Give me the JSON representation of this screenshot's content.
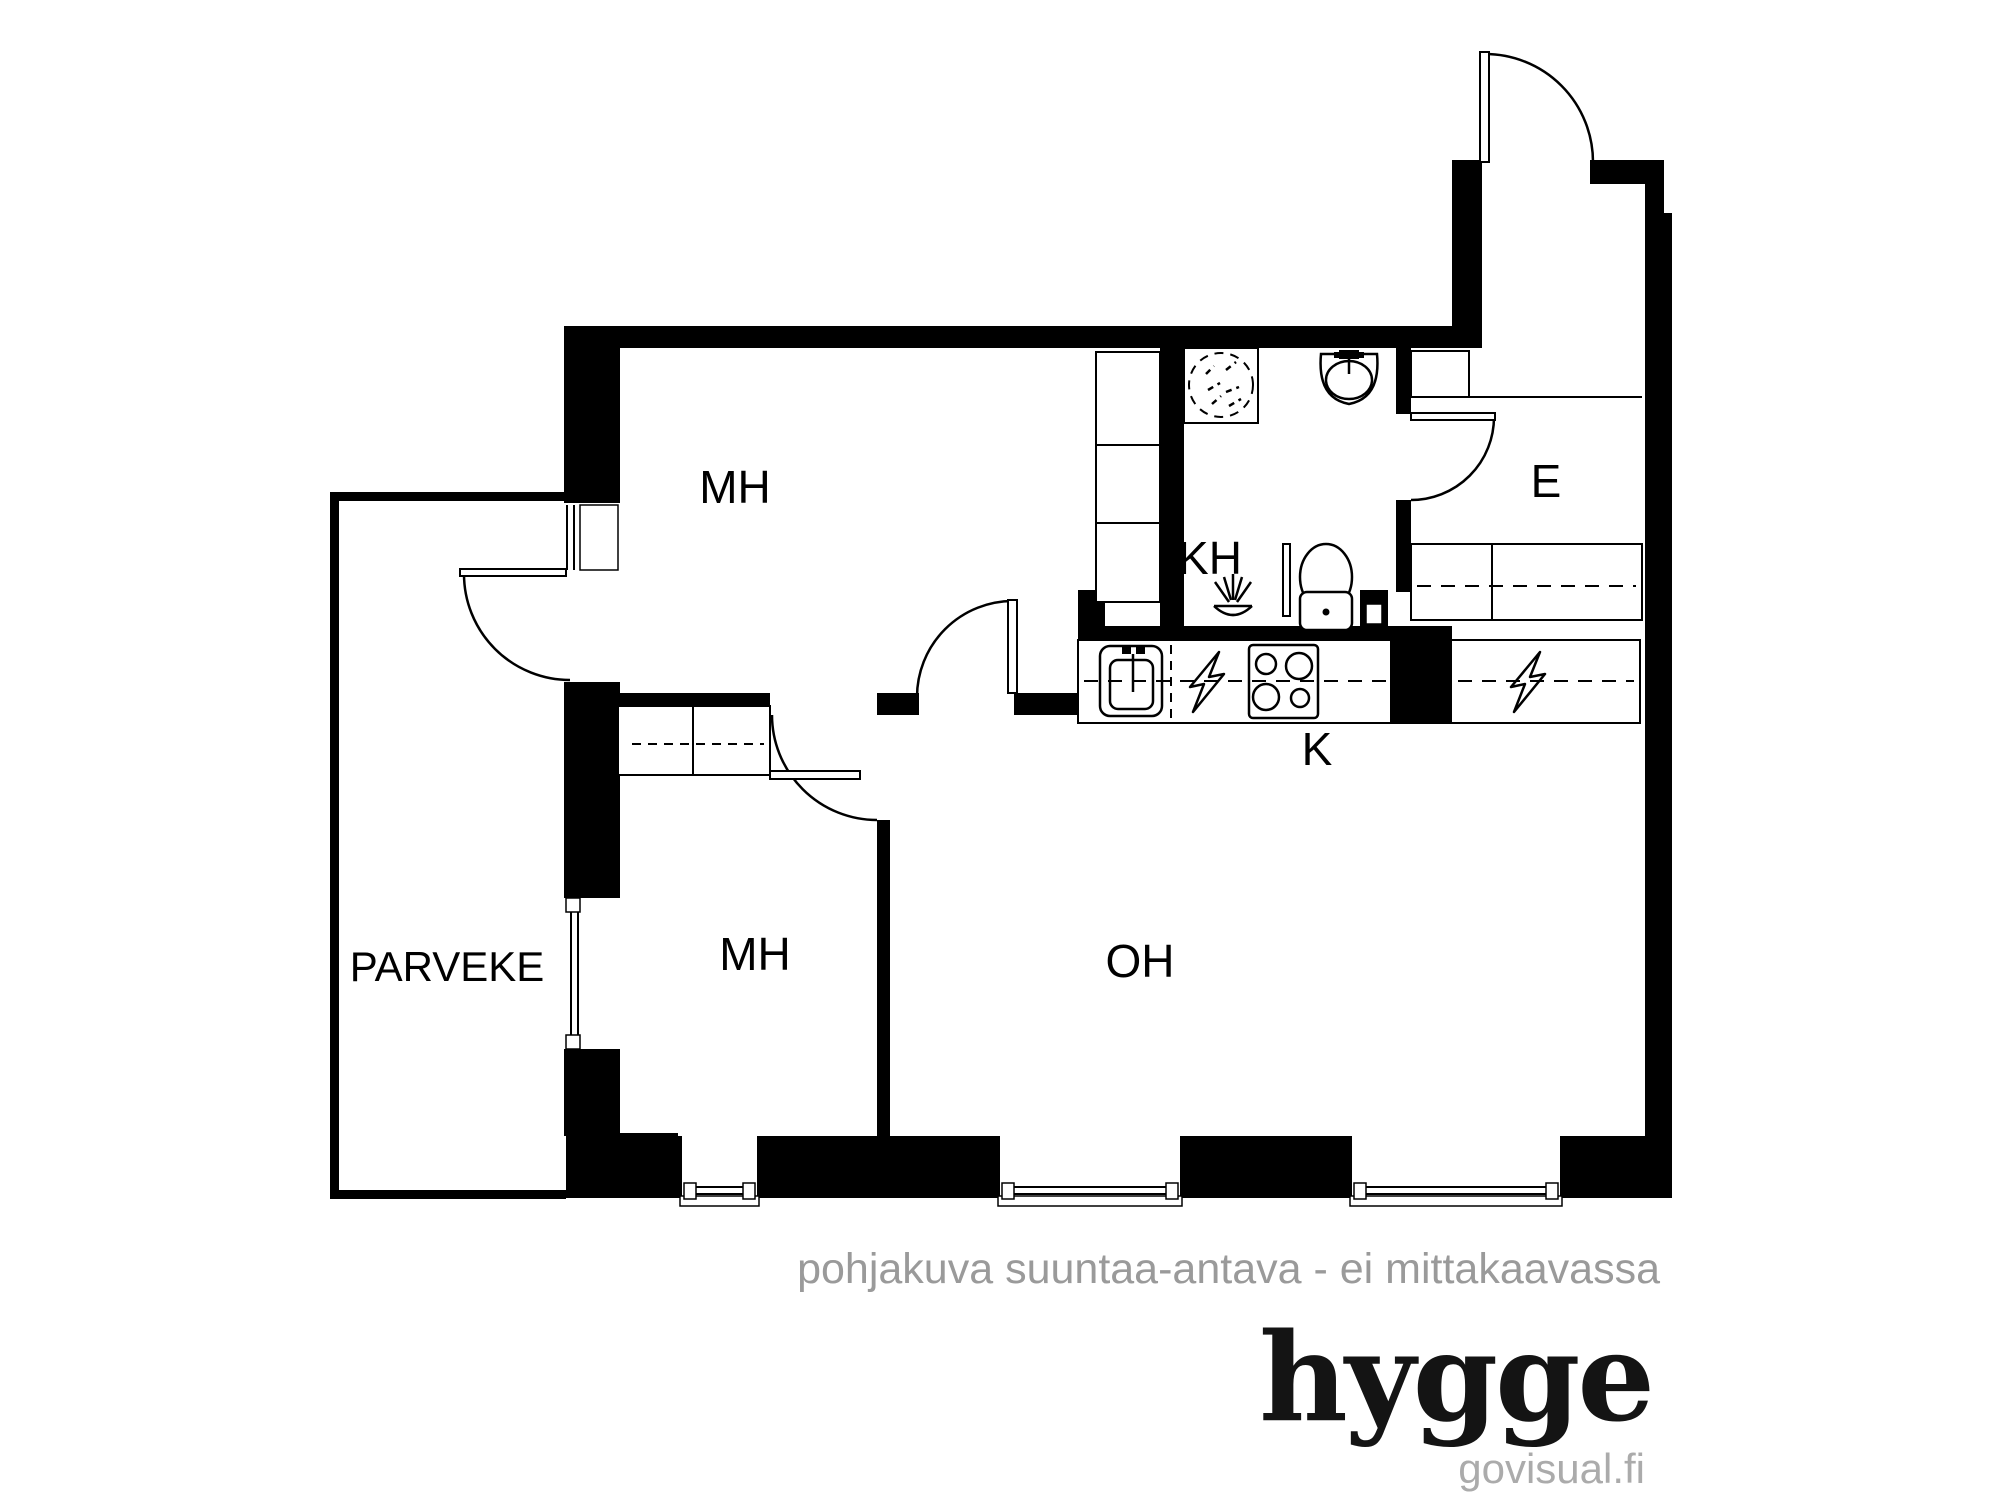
{
  "title": "hygge floor plan",
  "rooms": {
    "mh_top": {
      "label": "MH"
    },
    "mh_bottom": {
      "label": "MH"
    },
    "kh": {
      "label": "KH"
    },
    "e": {
      "label": "E"
    },
    "k": {
      "label": "K"
    },
    "oh": {
      "label": "OH"
    },
    "parveke": {
      "label": "PARVEKE"
    }
  },
  "icons": {
    "washing_machine": "washer-dryer-dashed-circle",
    "bathroom_sink": "wash-basin",
    "toilet": "wc-toilet",
    "floor_drain": "shower-floor-drain",
    "kitchen_sink": "kitchen-sink",
    "stove": "four-burner-stove",
    "electric": "lightning-bolt"
  },
  "footer": {
    "disclaimer": "pohjakuva suuntaa-antava - ei mittakaavassa",
    "brand": "hygge",
    "website": "govisual.fi"
  },
  "colors": {
    "wall": "#000000",
    "background": "#ffffff",
    "disclaimer_gray": "#9a9a9a",
    "brand_black": "#141414",
    "website_gray": "#ababab"
  }
}
